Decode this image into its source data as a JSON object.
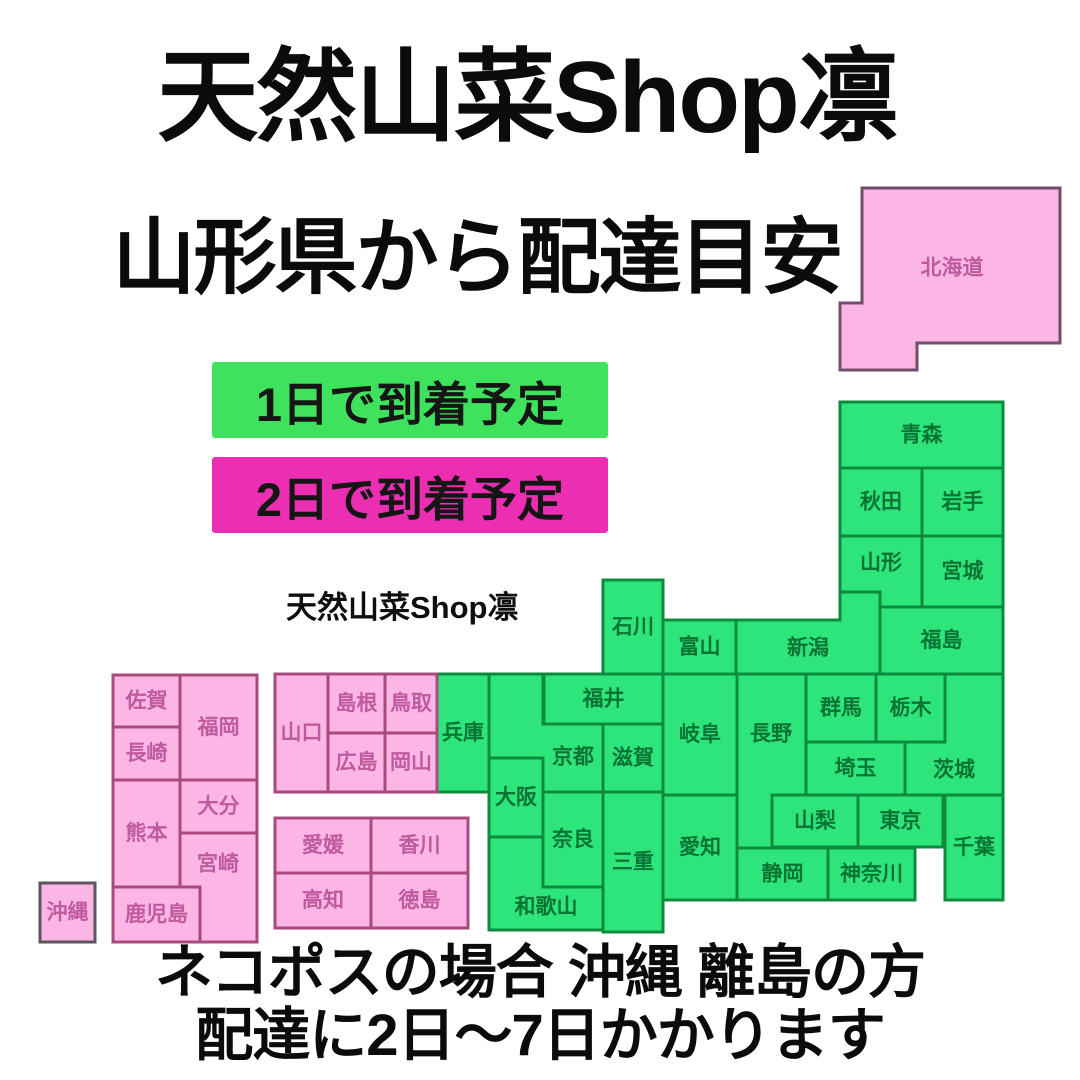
{
  "header": {
    "title": "天然山菜Shop凛",
    "subtitle": "山形県から配達目安"
  },
  "legend": {
    "items": [
      {
        "label": "1日で到着予定",
        "color": "#3ee25c"
      },
      {
        "label": "2日で到着予定",
        "color": "#ec2fb2"
      }
    ]
  },
  "watermark": "天然山菜Shop凛",
  "footer": {
    "line1": "ネコポスの場合 沖縄 離島の方",
    "line2": "配達に2日〜7日かかります"
  },
  "map": {
    "colors": {
      "green": {
        "fill": "#2ee57c",
        "stroke": "#0d8a3e",
        "text": "#0a7434"
      },
      "pink": {
        "fill": "#fbb6e6",
        "stroke": "#a84a7e",
        "text": "#c05a9e"
      }
    },
    "prefectures": [
      {
        "id": "hokkaido",
        "name": "北海道",
        "color": "pink",
        "stroke": "#714f6b",
        "poly": [
          [
            862,
            188
          ],
          [
            1060,
            188
          ],
          [
            1060,
            343
          ],
          [
            917,
            343
          ],
          [
            917,
            370
          ],
          [
            840,
            370
          ],
          [
            840,
            303
          ],
          [
            862,
            303
          ]
        ],
        "label": [
          952,
          268
        ]
      },
      {
        "id": "aomori",
        "name": "青森",
        "color": "green",
        "rect": [
          840,
          402,
          163,
          66
        ]
      },
      {
        "id": "akita",
        "name": "秋田",
        "color": "green",
        "rect": [
          840,
          468,
          82,
          68
        ]
      },
      {
        "id": "iwate",
        "name": "岩手",
        "color": "green",
        "rect": [
          922,
          468,
          81,
          68
        ]
      },
      {
        "id": "yamagata",
        "name": "山形",
        "color": "green",
        "poly": [
          [
            840,
            536
          ],
          [
            922,
            536
          ],
          [
            922,
            607
          ],
          [
            880,
            607
          ],
          [
            880,
            592
          ],
          [
            840,
            592
          ]
        ],
        "label": [
          881,
          563
        ]
      },
      {
        "id": "miyagi",
        "name": "宮城",
        "color": "green",
        "rect": [
          922,
          536,
          81,
          71
        ]
      },
      {
        "id": "fukushima",
        "name": "福島",
        "color": "green",
        "rect": [
          880,
          607,
          123,
          67
        ]
      },
      {
        "id": "niigata",
        "name": "新潟",
        "color": "green",
        "poly": [
          [
            736,
            620
          ],
          [
            840,
            620
          ],
          [
            840,
            592
          ],
          [
            880,
            592
          ],
          [
            880,
            674
          ],
          [
            736,
            674
          ]
        ],
        "label": [
          808,
          648
        ]
      },
      {
        "id": "toyama",
        "name": "富山",
        "color": "green",
        "rect": [
          663,
          620,
          73,
          54
        ]
      },
      {
        "id": "ishikawa",
        "name": "石川",
        "color": "green",
        "rect": [
          603,
          580,
          60,
          94
        ]
      },
      {
        "id": "fukui",
        "name": "福井",
        "color": "green",
        "rect": [
          544,
          674,
          119,
          50
        ]
      },
      {
        "id": "gunma",
        "name": "群馬",
        "color": "green",
        "rect": [
          806,
          674,
          70,
          68
        ]
      },
      {
        "id": "tochigi",
        "name": "栃木",
        "color": "green",
        "rect": [
          876,
          674,
          69,
          68
        ]
      },
      {
        "id": "ibaraki",
        "name": "茨城",
        "color": "green",
        "poly": [
          [
            905,
            742
          ],
          [
            945,
            742
          ],
          [
            945,
            674
          ],
          [
            1003,
            674
          ],
          [
            1003,
            795
          ],
          [
            905,
            795
          ]
        ],
        "label": [
          954,
          770
        ]
      },
      {
        "id": "saitama",
        "name": "埼玉",
        "color": "green",
        "rect": [
          806,
          742,
          99,
          53
        ]
      },
      {
        "id": "gifu",
        "name": "岐阜",
        "color": "green",
        "rect": [
          663,
          674,
          74,
          121
        ]
      },
      {
        "id": "nagano",
        "name": "長野",
        "color": "green",
        "poly": [
          [
            737,
            674
          ],
          [
            806,
            674
          ],
          [
            806,
            795
          ],
          [
            772,
            795
          ],
          [
            772,
            848
          ],
          [
            737,
            848
          ]
        ],
        "label": [
          771,
          734
        ]
      },
      {
        "id": "yamanashi",
        "name": "山梨",
        "color": "green",
        "rect": [
          772,
          795,
          86,
          52
        ]
      },
      {
        "id": "tokyo",
        "name": "東京",
        "color": "green",
        "rect": [
          858,
          795,
          85,
          52
        ]
      },
      {
        "id": "chiba",
        "name": "千葉",
        "color": "green",
        "rect": [
          945,
          795,
          58,
          105
        ]
      },
      {
        "id": "shizuoka",
        "name": "静岡",
        "color": "green",
        "rect": [
          737,
          848,
          91,
          52
        ]
      },
      {
        "id": "kanagawa",
        "name": "神奈川",
        "color": "green",
        "rect": [
          828,
          848,
          87,
          52
        ]
      },
      {
        "id": "aichi",
        "name": "愛知",
        "color": "green",
        "rect": [
          663,
          795,
          74,
          105
        ]
      },
      {
        "id": "mie",
        "name": "三重",
        "color": "green",
        "rect": [
          603,
          792,
          60,
          140
        ]
      },
      {
        "id": "shiga",
        "name": "滋賀",
        "color": "green",
        "rect": [
          603,
          724,
          60,
          68
        ]
      },
      {
        "id": "kyoto",
        "name": "京都",
        "color": "green",
        "poly": [
          [
            489,
            674
          ],
          [
            543,
            674
          ],
          [
            543,
            724
          ],
          [
            603,
            724
          ],
          [
            603,
            792
          ],
          [
            543,
            792
          ],
          [
            543,
            758
          ],
          [
            489,
            758
          ]
        ],
        "label": [
          573,
          757
        ]
      },
      {
        "id": "osaka",
        "name": "大阪",
        "color": "green",
        "rect": [
          489,
          758,
          54,
          79
        ]
      },
      {
        "id": "nara",
        "name": "奈良",
        "color": "green",
        "rect": [
          543,
          792,
          60,
          95
        ]
      },
      {
        "id": "wakayama",
        "name": "和歌山",
        "color": "green",
        "poly": [
          [
            489,
            837
          ],
          [
            543,
            837
          ],
          [
            543,
            887
          ],
          [
            603,
            887
          ],
          [
            603,
            930
          ],
          [
            489,
            930
          ]
        ],
        "label": [
          546,
          907
        ]
      },
      {
        "id": "hyogo",
        "name": "兵庫",
        "color": "green",
        "rect": [
          437,
          674,
          52,
          118
        ]
      },
      {
        "id": "yamaguchi",
        "name": "山口",
        "color": "pink",
        "rect": [
          275,
          674,
          53,
          118
        ]
      },
      {
        "id": "shimane",
        "name": "島根",
        "color": "pink",
        "rect": [
          328,
          674,
          57,
          59
        ]
      },
      {
        "id": "tottori",
        "name": "鳥取",
        "color": "pink",
        "rect": [
          385,
          674,
          52,
          59
        ]
      },
      {
        "id": "hiroshima",
        "name": "広島",
        "color": "pink",
        "rect": [
          328,
          733,
          57,
          59
        ]
      },
      {
        "id": "okayama",
        "name": "岡山",
        "color": "pink",
        "rect": [
          385,
          733,
          52,
          59
        ]
      },
      {
        "id": "ehime",
        "name": "愛媛",
        "color": "pink",
        "rect": [
          275,
          818,
          96,
          55
        ]
      },
      {
        "id": "kagawa",
        "name": "香川",
        "color": "pink",
        "rect": [
          371,
          818,
          97,
          55
        ]
      },
      {
        "id": "kochi",
        "name": "高知",
        "color": "pink",
        "rect": [
          275,
          873,
          96,
          55
        ]
      },
      {
        "id": "tokushima",
        "name": "徳島",
        "color": "pink",
        "rect": [
          371,
          873,
          97,
          55
        ]
      },
      {
        "id": "saga",
        "name": "佐賀",
        "color": "pink",
        "rect": [
          113,
          675,
          67,
          52
        ]
      },
      {
        "id": "fukuoka",
        "name": "福岡",
        "color": "pink",
        "rect": [
          180,
          675,
          77,
          105
        ]
      },
      {
        "id": "nagasaki",
        "name": "長崎",
        "color": "pink",
        "rect": [
          113,
          727,
          67,
          53
        ]
      },
      {
        "id": "oita",
        "name": "大分",
        "color": "pink",
        "rect": [
          180,
          780,
          77,
          53
        ]
      },
      {
        "id": "kumamoto",
        "name": "熊本",
        "color": "pink",
        "rect": [
          113,
          780,
          67,
          107
        ]
      },
      {
        "id": "miyazaki",
        "name": "宮崎",
        "color": "pink",
        "poly": [
          [
            180,
            833
          ],
          [
            257,
            833
          ],
          [
            257,
            942
          ],
          [
            200,
            942
          ],
          [
            200,
            887
          ],
          [
            180,
            887
          ]
        ],
        "label": [
          218,
          864
        ]
      },
      {
        "id": "kagoshima",
        "name": "鹿児島",
        "color": "pink",
        "rect": [
          113,
          887,
          87,
          55
        ]
      },
      {
        "id": "okinawa",
        "name": "沖縄",
        "color": "pink",
        "stroke": "#5c5560",
        "rect": [
          40,
          883,
          55,
          59
        ]
      }
    ]
  }
}
